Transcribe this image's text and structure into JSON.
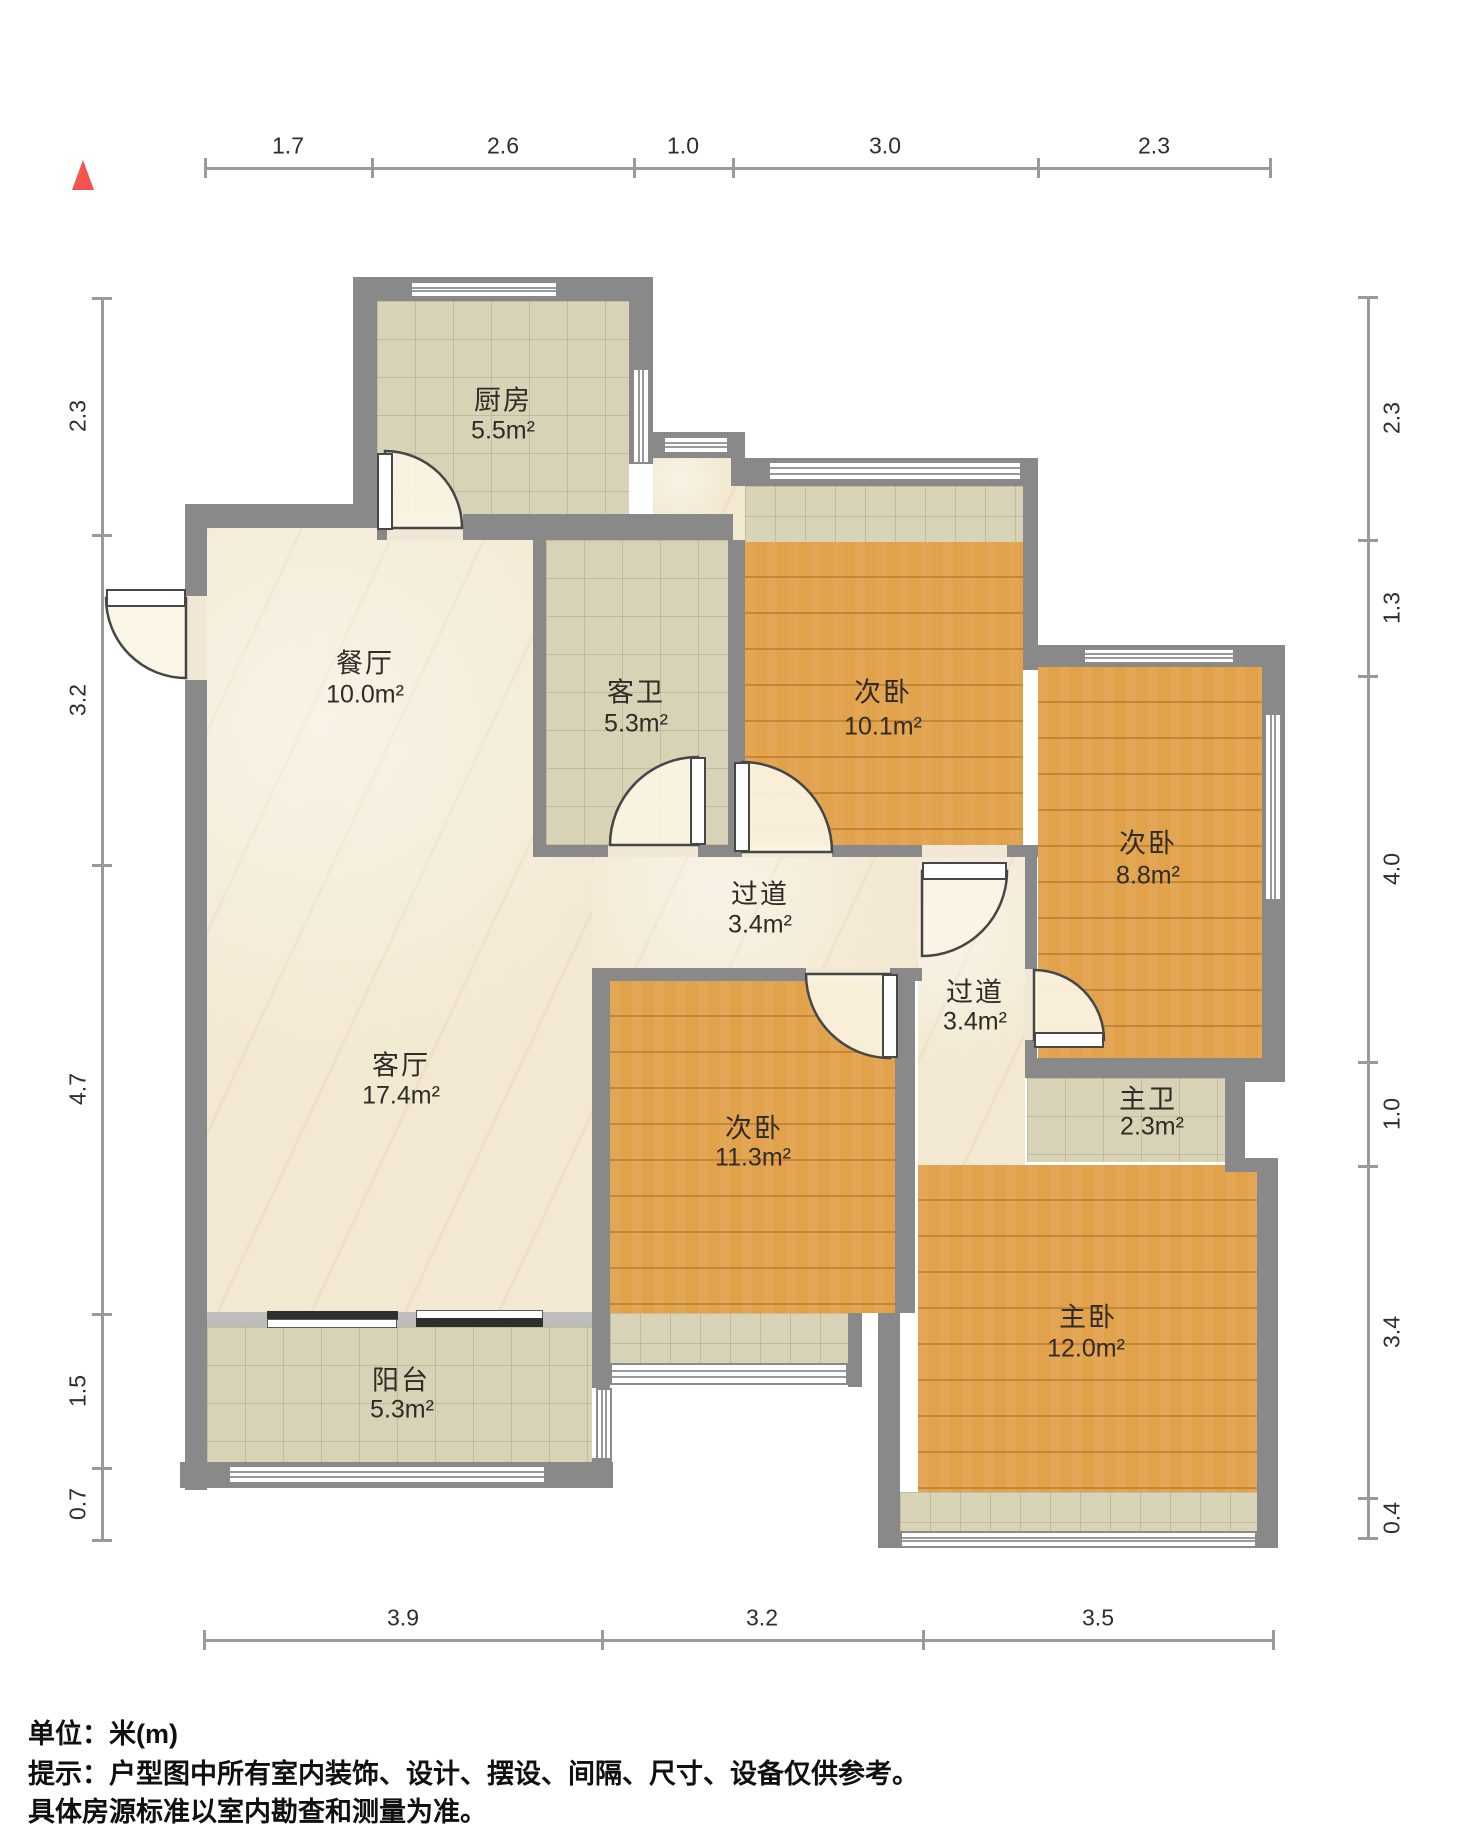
{
  "footer": {
    "line1": "单位：米(m)",
    "line2": "提示：户型图中所有室内装饰、设计、摆设、间隔、尺寸、设备仅供参考。",
    "line3": "具体房源标准以室内勘查和测量为准。"
  },
  "north": {
    "color": "#f2544f"
  },
  "rooms": [
    {
      "name": "厨房",
      "area": "5.5m²",
      "nx": 503,
      "ny": 398,
      "ax": 503,
      "ay": 431
    },
    {
      "name": "餐厅",
      "area": "10.0m²",
      "nx": 365,
      "ny": 661,
      "ax": 365,
      "ay": 695
    },
    {
      "name": "客卫",
      "area": "5.3m²",
      "nx": 636,
      "ny": 690,
      "ax": 636,
      "ay": 724
    },
    {
      "name": "次卧",
      "area": "10.1m²",
      "nx": 883,
      "ny": 690,
      "ax": 883,
      "ay": 727
    },
    {
      "name": "次卧",
      "area": "8.8m²",
      "nx": 1148,
      "ny": 841,
      "ax": 1148,
      "ay": 876
    },
    {
      "name": "过道",
      "area": "3.4m²",
      "nx": 760,
      "ny": 892,
      "ax": 760,
      "ay": 925
    },
    {
      "name": "过道",
      "area": "3.4m²",
      "nx": 975,
      "ny": 990,
      "ax": 975,
      "ay": 1022
    },
    {
      "name": "客厅",
      "area": "17.4m²",
      "nx": 401,
      "ny": 1063,
      "ax": 401,
      "ay": 1096
    },
    {
      "name": "次卧",
      "area": "11.3m²",
      "nx": 754,
      "ny": 1126,
      "ax": 753,
      "ay": 1158
    },
    {
      "name": "主卫",
      "area": "2.3m²",
      "nx": 1148,
      "ny": 1097,
      "ax": 1152,
      "ay": 1127
    },
    {
      "name": "主卧",
      "area": "12.0m²",
      "nx": 1088,
      "ny": 1315,
      "ax": 1086,
      "ay": 1349
    },
    {
      "name": "阳台",
      "area": "5.3m²",
      "nx": 401,
      "ny": 1378,
      "ax": 402,
      "ay": 1410
    }
  ],
  "dimensions": {
    "top": {
      "line": [
        205,
        168,
        1270,
        168
      ],
      "ticks": [
        [
          205,
          168
        ],
        [
          372,
          168
        ],
        [
          634,
          168
        ],
        [
          733,
          168
        ],
        [
          1038,
          168
        ],
        [
          1270,
          168
        ]
      ],
      "labels": [
        {
          "t": "1.7",
          "x": 288,
          "y": 146
        },
        {
          "t": "2.6",
          "x": 503,
          "y": 146
        },
        {
          "t": "1.0",
          "x": 683,
          "y": 146
        },
        {
          "t": "3.0",
          "x": 885,
          "y": 146
        },
        {
          "t": "2.3",
          "x": 1154,
          "y": 146
        }
      ]
    },
    "left": {
      "line": [
        102,
        298,
        102,
        1540
      ],
      "ticks": [
        [
          102,
          298
        ],
        [
          102,
          535
        ],
        [
          102,
          865
        ],
        [
          102,
          1314
        ],
        [
          102,
          1468
        ],
        [
          102,
          1540
        ]
      ],
      "labels": [
        {
          "t": "2.3",
          "x": 78,
          "y": 416,
          "v": true
        },
        {
          "t": "3.2",
          "x": 78,
          "y": 700,
          "v": true
        },
        {
          "t": "4.7",
          "x": 78,
          "y": 1089,
          "v": true
        },
        {
          "t": "1.5",
          "x": 78,
          "y": 1391,
          "v": true
        },
        {
          "t": "0.7",
          "x": 78,
          "y": 1504,
          "v": true
        }
      ]
    },
    "right": {
      "line": [
        1368,
        297,
        1368,
        1538
      ],
      "ticks": [
        [
          1368,
          297
        ],
        [
          1368,
          540
        ],
        [
          1368,
          676
        ],
        [
          1368,
          1062
        ],
        [
          1368,
          1166
        ],
        [
          1368,
          1498
        ],
        [
          1368,
          1538
        ]
      ],
      "labels": [
        {
          "t": "2.3",
          "x": 1392,
          "y": 418,
          "v": true
        },
        {
          "t": "1.3",
          "x": 1392,
          "y": 608,
          "v": true
        },
        {
          "t": "4.0",
          "x": 1392,
          "y": 869,
          "v": true
        },
        {
          "t": "1.0",
          "x": 1392,
          "y": 1114,
          "v": true
        },
        {
          "t": "3.4",
          "x": 1392,
          "y": 1332,
          "v": true
        },
        {
          "t": "0.4",
          "x": 1392,
          "y": 1518,
          "v": true
        }
      ]
    },
    "bottom": {
      "line": [
        204,
        1640,
        1273,
        1640
      ],
      "ticks": [
        [
          204,
          1640
        ],
        [
          602,
          1640
        ],
        [
          923,
          1640
        ],
        [
          1273,
          1640
        ]
      ],
      "labels": [
        {
          "t": "3.9",
          "x": 403,
          "y": 1618
        },
        {
          "t": "3.2",
          "x": 762,
          "y": 1618
        },
        {
          "t": "3.5",
          "x": 1098,
          "y": 1618
        }
      ]
    }
  },
  "plan": {
    "colors": {
      "wall": "#898989",
      "marble": "#f3e9d2",
      "tile": "#d8d2b6",
      "wood": "#e2a14b",
      "door_arc": "#464646",
      "slide_dark": "#2f2e2e"
    },
    "floors": [
      {
        "t": "marble",
        "n": "floor-dining-living",
        "r": [
          207,
          527,
          385,
          786
        ]
      },
      {
        "t": "marble",
        "n": "floor-dining-nook",
        "r": [
          653,
          458,
          92,
          84
        ]
      },
      {
        "t": "marble",
        "n": "floor-hallway",
        "r": [
          592,
          857,
          433,
          111
        ]
      },
      {
        "t": "marble",
        "n": "floor-corridor",
        "r": [
          918,
          857,
          107,
          308
        ]
      },
      {
        "t": "tile",
        "n": "floor-kitchen",
        "r": [
          377,
          301,
          252,
          213
        ]
      },
      {
        "t": "tile",
        "n": "floor-guest-bath",
        "r": [
          546,
          540,
          182,
          305
        ]
      },
      {
        "t": "tile",
        "n": "floor-master-bath",
        "r": [
          1027,
          1078,
          198,
          84
        ]
      },
      {
        "t": "tile",
        "n": "floor-balcony",
        "r": [
          207,
          1327,
          385,
          135
        ]
      },
      {
        "t": "f-sill",
        "c": "f-sill",
        "n": "floor-bay-sill-bed101",
        "r": [
          745,
          486,
          278,
          56
        ]
      },
      {
        "t": "f-sill",
        "c": "f-sill",
        "n": "floor-bay-sill-bed113",
        "r": [
          610,
          1313,
          238,
          50
        ]
      },
      {
        "t": "f-sill",
        "c": "f-sill",
        "n": "floor-bay-sill-master",
        "r": [
          900,
          1492,
          357,
          41
        ]
      },
      {
        "t": "wood",
        "n": "floor-bed101",
        "r": [
          745,
          542,
          278,
          303
        ]
      },
      {
        "t": "wood",
        "n": "floor-bed88",
        "r": [
          1038,
          667,
          224,
          391
        ]
      },
      {
        "t": "wood",
        "n": "floor-bed113",
        "r": [
          610,
          981,
          285,
          332
        ]
      },
      {
        "t": "wood",
        "n": "floor-master-bed",
        "r": [
          918,
          1165,
          339,
          327
        ]
      }
    ],
    "walls": [
      {
        "n": "wall-left-outer",
        "r": [
          185,
          504,
          22,
          986
        ]
      },
      {
        "n": "wall-dining-top",
        "r": [
          185,
          504,
          192,
          24
        ]
      },
      {
        "n": "wall-kitchen-left",
        "r": [
          353,
          277,
          24,
          250
        ]
      },
      {
        "n": "wall-kitchen-top",
        "r": [
          353,
          277,
          300,
          24
        ]
      },
      {
        "n": "wall-kitchen-right",
        "r": [
          629,
          277,
          24,
          187
        ]
      },
      {
        "n": "wall-top-north",
        "r": [
          645,
          432,
          100,
          26
        ]
      },
      {
        "n": "wall-bay101-head",
        "r": [
          731,
          458,
          307,
          28
        ]
      },
      {
        "n": "wall-bed101-right",
        "r": [
          1023,
          458,
          15,
          212
        ]
      },
      {
        "n": "wall-bed88-top",
        "r": [
          1038,
          645,
          247,
          22
        ]
      },
      {
        "n": "wall-right-outer",
        "r": [
          1262,
          645,
          23,
          435
        ]
      },
      {
        "n": "wall-mwc-step",
        "r": [
          1225,
          1068,
          60,
          14
        ]
      },
      {
        "n": "wall-mwc-right",
        "r": [
          1225,
          1078,
          20,
          92
        ]
      },
      {
        "n": "wall-master-step",
        "r": [
          1225,
          1158,
          40,
          14
        ]
      },
      {
        "n": "wall-master-right",
        "r": [
          1257,
          1158,
          21,
          390
        ]
      },
      {
        "n": "wall-kitchen-bottom-a",
        "r": [
          377,
          514,
          10,
          26
        ]
      },
      {
        "n": "wall-kitchen-bottom-b",
        "r": [
          461,
          514,
          272,
          26
        ]
      },
      {
        "n": "wall-guestbath-left",
        "r": [
          533,
          540,
          13,
          305
        ]
      },
      {
        "n": "wall-guestbath-right",
        "r": [
          728,
          540,
          17,
          317
        ]
      },
      {
        "n": "wall-hall-top-a",
        "r": [
          533,
          845,
          75,
          12
        ]
      },
      {
        "n": "wall-hall-top-b",
        "r": [
          698,
          845,
          44,
          12
        ]
      },
      {
        "n": "wall-hall-top-c",
        "r": [
          832,
          845,
          90,
          12
        ]
      },
      {
        "n": "wall-hall-top-d",
        "r": [
          1007,
          845,
          31,
          12
        ]
      },
      {
        "n": "wall-living-right",
        "r": [
          592,
          968,
          18,
          345
        ]
      },
      {
        "n": "wall-hall-bottom-a",
        "r": [
          592,
          968,
          214,
          13
        ]
      },
      {
        "n": "wall-hall-bottom-b",
        "r": [
          890,
          968,
          32,
          13
        ]
      },
      {
        "n": "wall-corridor-left",
        "r": [
          895,
          981,
          20,
          332
        ]
      },
      {
        "n": "wall-corridor-right-a",
        "r": [
          1025,
          857,
          12,
          112
        ]
      },
      {
        "n": "wall-corridor-right-b",
        "r": [
          1025,
          1040,
          12,
          28
        ]
      },
      {
        "n": "wall-bed88-bottom",
        "r": [
          1025,
          1058,
          237,
          20
        ]
      },
      {
        "n": "wall-south-mid",
        "r": [
          878,
          1313,
          22,
          235
        ]
      },
      {
        "n": "wall-bay113-right",
        "r": [
          848,
          1313,
          14,
          74
        ]
      },
      {
        "n": "wall-balcony-right-a",
        "r": [
          592,
          1313,
          18,
          75
        ]
      },
      {
        "n": "wall-balcony-right-b",
        "r": [
          592,
          1458,
          20,
          30
        ]
      },
      {
        "n": "wall-balcony-bottom",
        "r": [
          180,
          1462,
          433,
          26
        ]
      },
      {
        "n": "sill-living-balcony",
        "c": "wall2",
        "r": [
          207,
          1312,
          385,
          15
        ]
      },
      {
        "n": "mullion-bay101",
        "r": [
          893,
          461,
          13,
          20
        ]
      },
      {
        "n": "mullion-bay113",
        "r": [
          718,
          1363,
          12,
          22
        ]
      },
      {
        "n": "mullion-master-bay",
        "r": [
          1098,
          1531,
          13,
          17
        ]
      }
    ],
    "openings": [
      {
        "n": "opening-entry",
        "r": [
          185,
          596,
          22,
          84
        ]
      },
      {
        "n": "opening-kitchen",
        "r": [
          387,
          514,
          76,
          26
        ]
      },
      {
        "n": "opening-guest-bath",
        "r": [
          608,
          845,
          90,
          12
        ]
      },
      {
        "n": "opening-bed101",
        "r": [
          742,
          845,
          90,
          12
        ]
      },
      {
        "n": "opening-corridor",
        "r": [
          922,
          845,
          85,
          12
        ]
      },
      {
        "n": "opening-bed113",
        "r": [
          806,
          968,
          84,
          13
        ]
      },
      {
        "n": "opening-bed88",
        "r": [
          1025,
          969,
          12,
          71
        ]
      }
    ],
    "windows": [
      {
        "n": "window-kitchen-top",
        "d": "h",
        "r": [
          410,
          281,
          148,
          17
        ]
      },
      {
        "n": "window-kitchen-right",
        "d": "v",
        "r": [
          632,
          368,
          18,
          96
        ]
      },
      {
        "n": "window-north-small",
        "d": "h",
        "r": [
          663,
          436,
          66,
          18
        ]
      },
      {
        "n": "window-bay-bed101",
        "d": "h",
        "r": [
          768,
          461,
          254,
          20
        ]
      },
      {
        "n": "window-bed88-top",
        "d": "h",
        "r": [
          1083,
          648,
          152,
          16
        ]
      },
      {
        "n": "window-bed88-right",
        "d": "v",
        "r": [
          1264,
          713,
          18,
          188
        ]
      },
      {
        "n": "window-bay-bed113",
        "d": "h",
        "r": [
          610,
          1363,
          238,
          22
        ]
      },
      {
        "n": "window-master-bay",
        "d": "h",
        "r": [
          900,
          1531,
          357,
          17
        ]
      },
      {
        "n": "window-balcony-bottom",
        "d": "h",
        "r": [
          228,
          1465,
          318,
          19
        ]
      },
      {
        "n": "window-balcony-right",
        "d": "v",
        "r": [
          596,
          1388,
          16,
          72
        ]
      }
    ],
    "doors": [
      {
        "n": "door-entry",
        "pie": "M186,598 L106,598 A80,80 0 0 0 186,678 Z",
        "leaf": [
          106,
          589,
          80,
          18
        ]
      },
      {
        "n": "door-kitchen",
        "pie": "M385,528 L385,451 A77,77 0 0 1 462,528 Z",
        "leaf": [
          377,
          453,
          16,
          77
        ]
      },
      {
        "n": "door-guest-bath",
        "pie": "M698,845 L698,757 A88,88 0 0 0 610,845 Z",
        "leaf": [
          690,
          757,
          16,
          88
        ]
      },
      {
        "n": "door-bed101",
        "pie": "M742,852 L742,762 A90,90 0 0 1 832,852 Z",
        "leaf": [
          734,
          762,
          16,
          90
        ]
      },
      {
        "n": "door-corridor",
        "pie": "M922,871 L1007,871 A85,85 0 0 1 922,956 Z",
        "leaf": [
          922,
          862,
          85,
          18
        ]
      },
      {
        "n": "door-bed113",
        "pie": "M890,974 L806,974 A84,84 0 0 0 890,1058 Z",
        "leaf": [
          882,
          974,
          16,
          84
        ]
      },
      {
        "n": "door-bed88",
        "pie": "M1034,1040 L1034,970 A70,70 0 0 1 1104,1040 Z",
        "leaf": [
          1034,
          1032,
          70,
          16
        ]
      }
    ],
    "slide": [
      {
        "n": "slide-panel-dark-left",
        "c": "dark",
        "r": [
          267,
          1311,
          131,
          9
        ]
      },
      {
        "n": "slide-panel-white-left",
        "c": "white",
        "r": [
          267,
          1319,
          130,
          9
        ]
      },
      {
        "n": "slide-panel-white-right",
        "c": "white",
        "r": [
          416,
          1310,
          127,
          9
        ]
      },
      {
        "n": "slide-panel-dark-right",
        "c": "dark",
        "r": [
          416,
          1318,
          127,
          9
        ]
      }
    ]
  }
}
